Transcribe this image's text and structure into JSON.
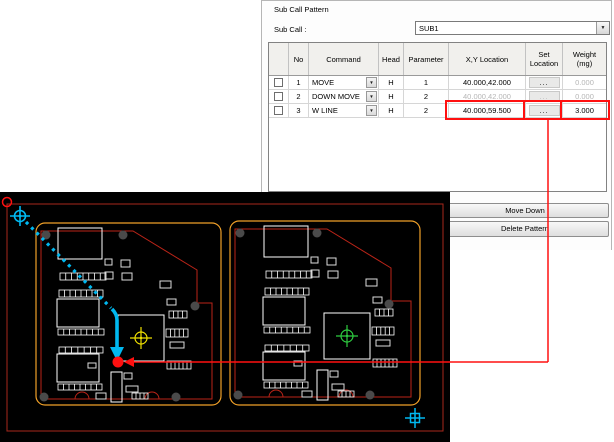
{
  "panel": {
    "title": "Sub Call Pattern",
    "sub_call_label": "Sub Call :",
    "sub_call_value": "SUB1",
    "move_down_label": "Move Down",
    "delete_pattern_label": "Delete Pattern",
    "table": {
      "columns": [
        {
          "key": "sel",
          "label": "",
          "w": 20
        },
        {
          "key": "no",
          "label": "No",
          "w": 20
        },
        {
          "key": "command",
          "label": "Command",
          "w": 70
        },
        {
          "key": "head",
          "label": "Head",
          "w": 25
        },
        {
          "key": "parameter",
          "label": "Parameter",
          "w": 45
        },
        {
          "key": "xy",
          "label": "X,Y Location",
          "w": 77
        },
        {
          "key": "set",
          "label": "Set Location",
          "w": 37,
          "wrap": true
        },
        {
          "key": "weight",
          "label": "Weight (mg)",
          "w": 44,
          "wrap": true
        }
      ],
      "rows": [
        {
          "no": "1",
          "command": "MOVE",
          "head": "H",
          "parameter": "1",
          "xy": "40.000,42.000",
          "set": "...",
          "weight": "0.000",
          "dim": [
            "weight"
          ]
        },
        {
          "no": "2",
          "command": "DOWN MOVE",
          "head": "H",
          "parameter": "2",
          "xy": "40.000,42.000",
          "set": "...",
          "weight": "0.000",
          "dim": [
            "xy",
            "set",
            "weight"
          ]
        },
        {
          "no": "3",
          "command": "W LINE",
          "head": "H",
          "parameter": "2",
          "xy": "40.000,59.500",
          "set": "...",
          "weight": "3.000",
          "dim": []
        }
      ]
    }
  },
  "pcb": {
    "x": 0,
    "y": 192,
    "w": 450,
    "h": 250,
    "colors": {
      "bg": "#000000",
      "frame": "#a8281c",
      "outline": "#f0a028",
      "rout": "#bb2418",
      "silk": "#ffffff",
      "hole": "#4a4a4a",
      "cyan": "#00b8f0",
      "red": "#ff1010",
      "cross_left": "#f0e000",
      "cross_right": "#2ecc40"
    },
    "frame_rect": [
      7,
      12,
      436,
      227
    ],
    "boards": [
      {
        "x": 36,
        "y": 31,
        "w": 185,
        "h": 182,
        "dx": 0,
        "cross": "#f0e000",
        "cross_name": "fiducial-crosshair-yellow"
      },
      {
        "x": 230,
        "y": 29,
        "w": 190,
        "h": 184,
        "dx": 12,
        "cross": "#2ecc40",
        "cross_name": "fiducial-crosshair-green"
      }
    ],
    "rout_shape": {
      "pts": [
        [
          5,
          8
        ],
        [
          97,
          8
        ],
        [
          161,
          47
        ],
        [
          161,
          80
        ]
      ],
      "bottom": 176,
      "notches": [
        46,
        116
      ]
    },
    "cross_center": [
      105,
      115
    ],
    "components": [
      {
        "t": "r",
        "x": 22,
        "y": 5,
        "w": 44,
        "h": 31
      },
      {
        "t": "p",
        "x": 24,
        "y": 50,
        "w": 46,
        "h": 7,
        "n": 8
      },
      {
        "t": "p",
        "x": 23,
        "y": 67,
        "w": 44,
        "h": 7,
        "n": 8
      },
      {
        "t": "r",
        "x": 21,
        "y": 76,
        "w": 42,
        "h": 28
      },
      {
        "t": "p",
        "x": 22,
        "y": 106,
        "w": 46,
        "h": 6,
        "n": 8
      },
      {
        "t": "p",
        "x": 23,
        "y": 124,
        "w": 44,
        "h": 6,
        "n": 7
      },
      {
        "t": "r",
        "x": 21,
        "y": 131,
        "w": 42,
        "h": 28
      },
      {
        "t": "p",
        "x": 22,
        "y": 161,
        "w": 44,
        "h": 6,
        "n": 8
      },
      {
        "t": "r",
        "x": 82,
        "y": 92,
        "w": 46,
        "h": 46
      },
      {
        "t": "r",
        "x": 75,
        "y": 149,
        "w": 11,
        "h": 30
      },
      {
        "t": "s",
        "x": 69,
        "y": 36,
        "w": 7,
        "h": 6
      },
      {
        "t": "s",
        "x": 85,
        "y": 37,
        "w": 9,
        "h": 7
      },
      {
        "t": "s",
        "x": 69,
        "y": 49,
        "w": 8,
        "h": 7
      },
      {
        "t": "s",
        "x": 86,
        "y": 50,
        "w": 10,
        "h": 7
      },
      {
        "t": "s",
        "x": 124,
        "y": 58,
        "w": 11,
        "h": 7
      },
      {
        "t": "s",
        "x": 131,
        "y": 76,
        "w": 9,
        "h": 6
      },
      {
        "t": "p",
        "x": 133,
        "y": 88,
        "w": 18,
        "h": 7,
        "n": 4
      },
      {
        "t": "p",
        "x": 130,
        "y": 106,
        "w": 22,
        "h": 8,
        "n": 5
      },
      {
        "t": "s",
        "x": 134,
        "y": 119,
        "w": 14,
        "h": 6
      },
      {
        "t": "p",
        "x": 131,
        "y": 138,
        "w": 24,
        "h": 8,
        "n": 6
      },
      {
        "t": "s",
        "x": 52,
        "y": 140,
        "w": 8,
        "h": 5
      },
      {
        "t": "s",
        "x": 60,
        "y": 170,
        "w": 10,
        "h": 6
      },
      {
        "t": "s",
        "x": 88,
        "y": 150,
        "w": 8,
        "h": 6
      },
      {
        "t": "s",
        "x": 90,
        "y": 163,
        "w": 12,
        "h": 6
      },
      {
        "t": "p",
        "x": 96,
        "y": 170,
        "w": 16,
        "h": 6,
        "n": 4
      }
    ],
    "holes": [
      [
        10,
        12
      ],
      [
        87,
        12
      ],
      [
        8,
        174
      ],
      [
        140,
        174
      ],
      [
        159,
        83
      ]
    ],
    "markers": {
      "ring": [
        7,
        10
      ],
      "origin_cross": [
        20,
        24
      ],
      "dotted_line": [
        26,
        30,
        111,
        116
      ],
      "arrow_path": "M112,117 Q117,122 117,128 L117,156",
      "arrow_head": [
        [
          110,
          155
        ],
        [
          124,
          155
        ],
        [
          117,
          169
        ]
      ],
      "target_dot": [
        118,
        170
      ],
      "br_cross": [
        415,
        226
      ]
    }
  },
  "overlay": {
    "color": "#ff1010",
    "boxes": [
      [
        446,
        101,
        78,
        18
      ],
      [
        524,
        101,
        37,
        18
      ],
      [
        561,
        101,
        48,
        18
      ]
    ],
    "vline": [
      548,
      119,
      548,
      362
    ],
    "hline": [
      133,
      362,
      548,
      362
    ],
    "arrow_head": [
      [
        124,
        362
      ],
      [
        134,
        357
      ],
      [
        134,
        367
      ]
    ]
  }
}
